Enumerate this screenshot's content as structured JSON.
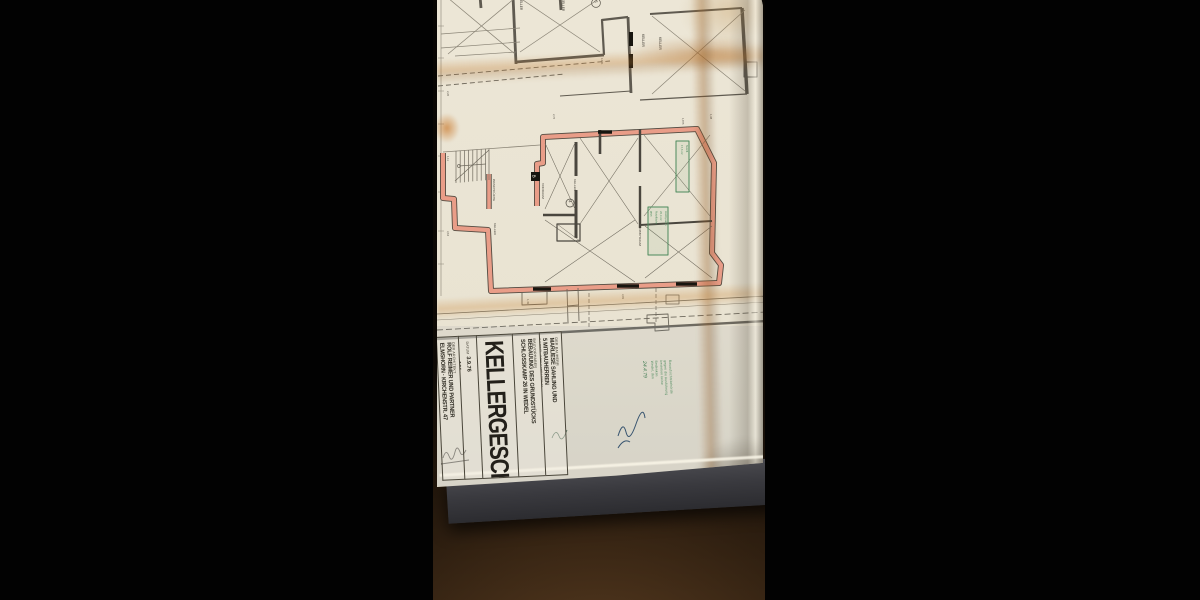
{
  "colors": {
    "background": "#020202",
    "paper": "#e9e3d2",
    "red_wall_fill": "#e99d88",
    "wall_dark": "#514a42",
    "green_stamp": "#4c8a5c",
    "wood_mid": "#4a3017",
    "mat_gray": "#3a3a3f"
  },
  "title_block": {
    "bauherr": {
      "label": "DER BAUHERR",
      "line1": "MARLIESE SAHLING UND",
      "line2": "5 MITBAUHERREN",
      "line3": "2 WEDEL, SCHULSTRASSE 26"
    },
    "bauvorhaben": {
      "label": "BAUVORHABEN",
      "line1": "BEBAUUNG DES GRUNDSTÜCKS",
      "line2": "SCHLOSSKAMP 26 IN WEDEL"
    },
    "title": "KELLERGESCHOSS",
    "meta": {
      "datum_label": "DATUM",
      "datum": "3.9.76",
      "plan_label": "PLAN NR.",
      "plan": "101",
      "massstab_label": "MASSSTAB",
      "massstab": "1:50"
    },
    "architekt": {
      "label": "DER ARCHITEKT",
      "line1": "ROLF REIMER UND PARTNER",
      "line2": "ELMSHORN · KIRCHENSTR. 47"
    }
  },
  "stamps": {
    "approval_lines": [
      "Bauaufsichtsbehörde",
      "gegen die Ausführung",
      "bestehen keine",
      "Bedenken",
      "Wedel, den"
    ],
    "approval_date": "24.4.79",
    "plan_box_small_lines": [
      "Nutzfl.",
      "17,6 m²"
    ],
    "plan_box_large_lines": [
      "Hobbyraum",
      "26,4 m²",
      "Nutzfläche",
      "gepr."
    ]
  },
  "plan": {
    "labels": [
      {
        "text": "KELLER",
        "x": 520,
        "y": 2,
        "s": 3.2
      },
      {
        "text": "KELLER",
        "x": 562,
        "y": 3,
        "s": 3.2
      },
      {
        "text": "6",
        "x": 594.5,
        "y": 4.2,
        "s": 4.2
      },
      {
        "text": "KELLER",
        "x": 642,
        "y": 38,
        "s": 3.4
      },
      {
        "text": "KELLER",
        "x": 659,
        "y": 41,
        "s": 3.4
      },
      {
        "text": "WASCHKÜCHE",
        "x": 493,
        "y": 183,
        "s": 3.1
      },
      {
        "text": "VORRAUM",
        "x": 542,
        "y": 187,
        "s": 3.1
      },
      {
        "text": "KELLER",
        "x": 574,
        "y": 183,
        "s": 3.1
      },
      {
        "text": "4",
        "x": 568.6,
        "y": 204.2,
        "s": 4.2
      },
      {
        "text": "HOBBYRAUM",
        "x": 639,
        "y": 230,
        "s": 3.1
      },
      {
        "text": "KELLER",
        "x": 494,
        "y": 227,
        "s": 3.1
      },
      {
        "text": "B",
        "x": 532.6,
        "y": 178.6,
        "s": 4.6,
        "color": "#f3efe2"
      }
    ],
    "dimensions": [
      {
        "text": "2,26",
        "x": 447,
        "y": 95
      },
      {
        "text": "1,11",
        "x": 447,
        "y": 160
      },
      {
        "text": "3,64",
        "x": 447,
        "y": 235
      },
      {
        "text": "1,49",
        "x": 527,
        "y": 303
      },
      {
        "text": "3,99",
        "x": 622,
        "y": 298
      },
      {
        "text": "1,38",
        "x": 710,
        "y": 118
      },
      {
        "text": "14,61",
        "x": 601,
        "y": 62
      },
      {
        "text": "2,76",
        "x": 553,
        "y": 118
      },
      {
        "text": "1,875",
        "x": 682,
        "y": 122
      }
    ]
  }
}
